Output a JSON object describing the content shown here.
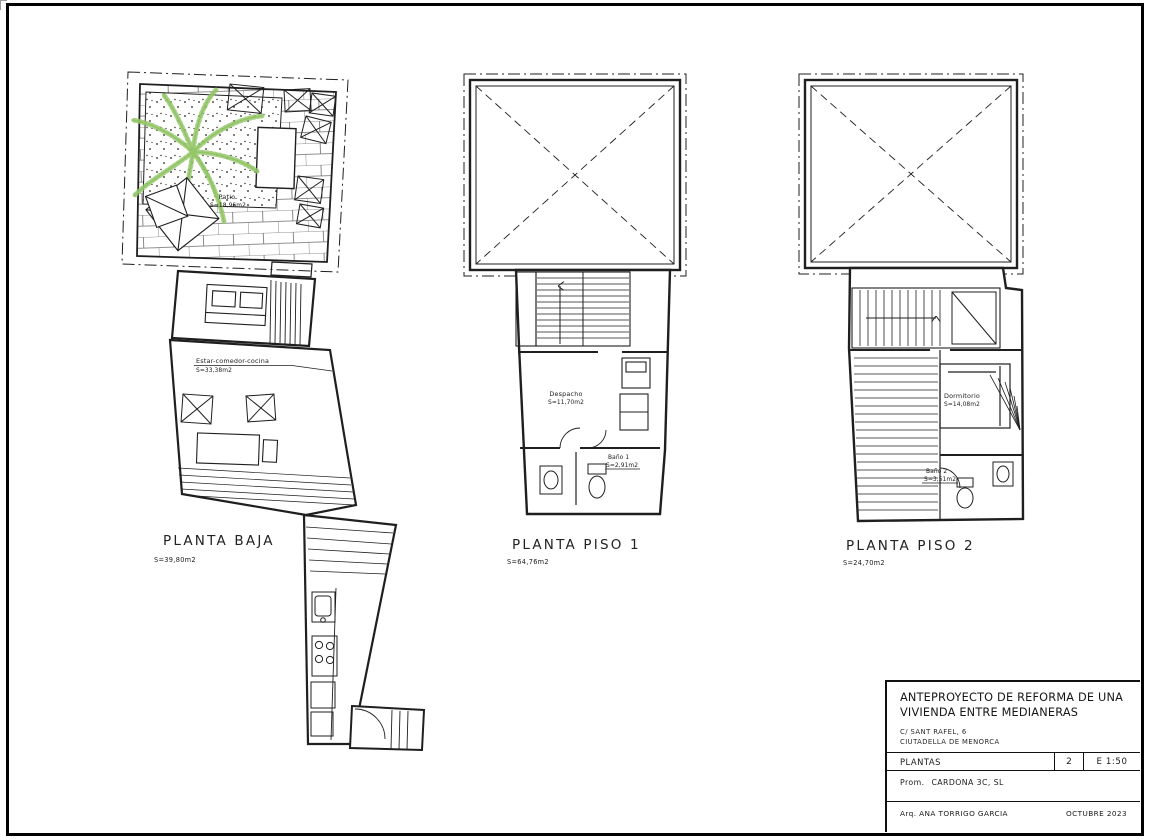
{
  "colors": {
    "plant_green": "#92c566",
    "line": "#1f1f1f"
  },
  "icons": {
    "plant": "palm-plant-icon",
    "stair_arrow": "stair-direction-arrow-icon"
  },
  "plans": {
    "planta_baja": {
      "title": "PLANTA BAJA",
      "area": "S=39,80m2",
      "patio": {
        "label": "Patio",
        "area": "S=18,96m2"
      },
      "estar": {
        "label": "Estar-comedor-cocina",
        "area": "S=33,38m2"
      }
    },
    "piso1": {
      "title": "PLANTA PISO 1",
      "area": "S=64,76m2",
      "despacho": {
        "label": "Despacho",
        "area": "S=11,70m2"
      },
      "bano1": {
        "label": "Baño 1",
        "area": "S=2,91m2"
      }
    },
    "piso2": {
      "title": "PLANTA PISO 2",
      "area": "S=24,70m2",
      "dormitorio": {
        "label": "Dormitorio",
        "area": "S=14,08m2"
      },
      "bano2": {
        "label": "Baño 2",
        "area": "S=3,51m2"
      }
    }
  },
  "titleblock": {
    "project_title": "ANTEPROYECTO DE REFORMA DE UNA VIVIENDA ENTRE MEDIANERAS",
    "address_line1": "C/ SANT RAFEL, 6",
    "address_line2": "CIUTADELLA DE MENORCA",
    "sheet_name": "PLANTAS",
    "sheet_number": "2",
    "scale": "E 1:50",
    "promoter_label": "Prom.",
    "promoter": "CARDONA 3C, SL",
    "architect_label": "Arq.",
    "architect": "ANA TORRIGO GARCIA",
    "date": "OCTUBRE 2023"
  }
}
